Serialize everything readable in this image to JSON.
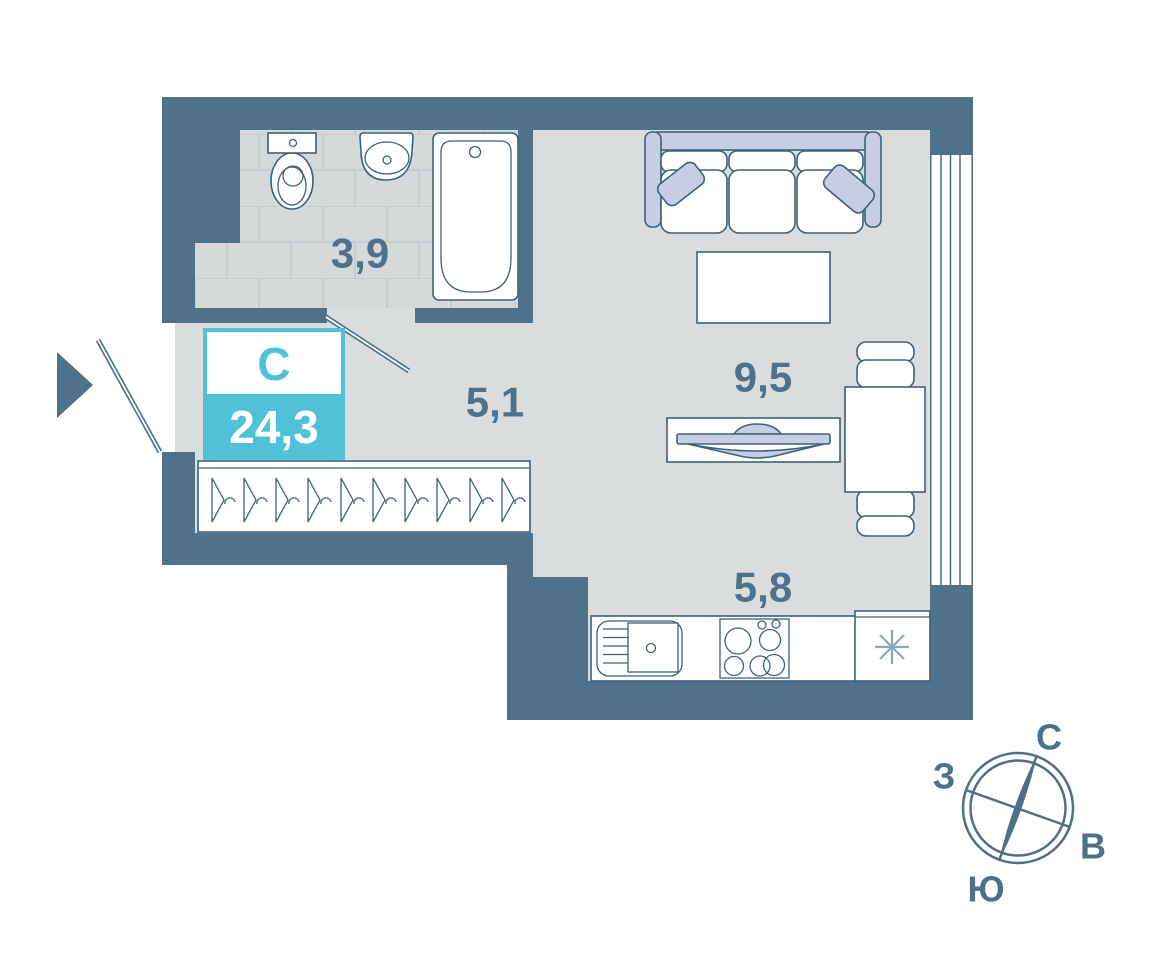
{
  "unit": {
    "type_label": "С",
    "total_area": "24,3"
  },
  "areas": {
    "bathroom": "3,9",
    "hallway": "5,1",
    "living_room": "9,5",
    "kitchen": "5,8"
  },
  "compass": {
    "north": "С",
    "east": "В",
    "south": "Ю",
    "west": "З"
  },
  "colors": {
    "wall": "#4F7189",
    "floor": "#D9DDDD",
    "tile": "#D4D9DA",
    "accent": "#50C2D7",
    "furniture": "#C7CEE4",
    "outline": "#3E617A",
    "label_text": "#4F7189",
    "white": "#FFFFFF"
  }
}
